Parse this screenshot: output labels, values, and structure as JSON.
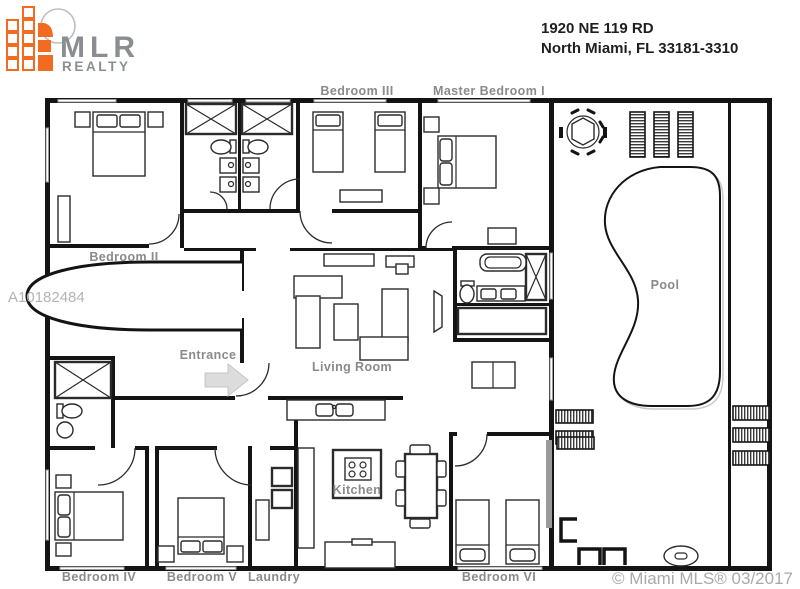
{
  "header": {
    "logo": {
      "brand": "MLR",
      "tagline": "REALTY"
    },
    "address_line1": "1920 NE 119 RD",
    "address_line2": "North Miami, FL  33181-3310"
  },
  "plan": {
    "rooms": {
      "bedroom2": "Bedroom II",
      "bedroom3": "Bedroom III",
      "master": "Master Bedroom I",
      "entrance": "Entrance",
      "living": "Living Room",
      "kitchen": "Kitchen",
      "laundry": "Laundry",
      "bedroom4": "Bedroom IV",
      "bedroom5": "Bedroom V",
      "bedroom6": "Bedroom VI",
      "pool": "Pool"
    },
    "watermark_id": "A10182484",
    "copyright": "© Miami MLS® 03/2017"
  },
  "colors": {
    "accent_orange": "#f26b21",
    "logo_gray": "#8b8e90",
    "wall_black": "#141414",
    "label_gray": "#8a8a8a",
    "watermark_gray": "#b4b4b4"
  }
}
